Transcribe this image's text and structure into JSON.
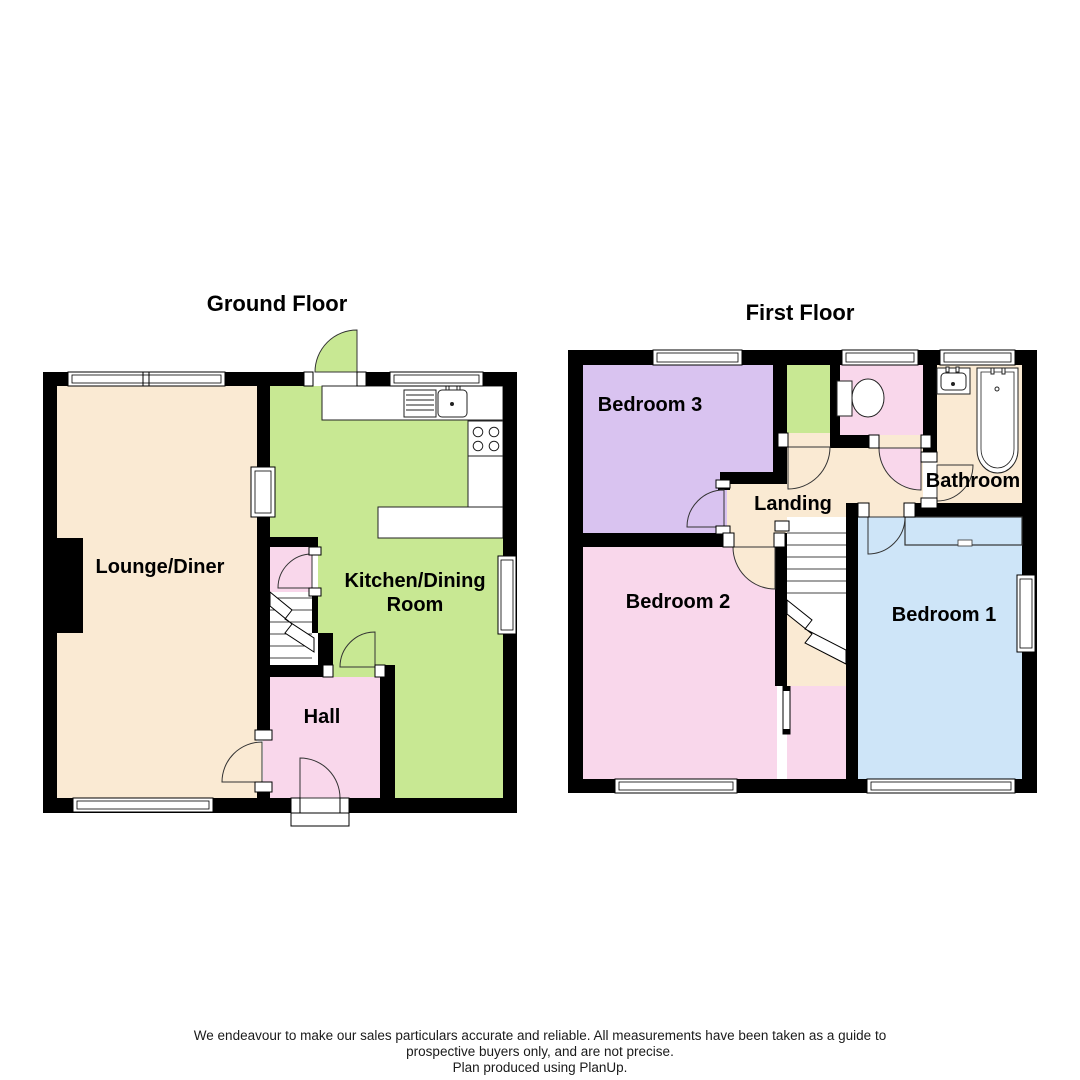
{
  "titles": {
    "ground_floor": "Ground Floor",
    "first_floor": "First Floor"
  },
  "rooms": {
    "lounge_diner": "Lounge/Diner",
    "kitchen_dining_line1": "Kitchen/Dining",
    "kitchen_dining_line2": "Room",
    "hall": "Hall",
    "bedroom_1": "Bedroom 1",
    "bedroom_2": "Bedroom 2",
    "bedroom_3": "Bedroom 3",
    "landing": "Landing",
    "bathroom": "Bathroom"
  },
  "footer": {
    "line1": "We endeavour to make our sales particulars accurate and reliable. All measurements have been taken as a guide to",
    "line2": "prospective buyers only, and are not precise.",
    "line3": "Plan produced using PlanUp."
  },
  "colors": {
    "wall": "#000000",
    "cream": "#FAEAD3",
    "green": "#C8E893",
    "pink": "#F9D7EB",
    "purple": "#D9C3F0",
    "blue": "#CEE5F8",
    "text": "#000000",
    "footer_text": "#1a1a1a"
  }
}
